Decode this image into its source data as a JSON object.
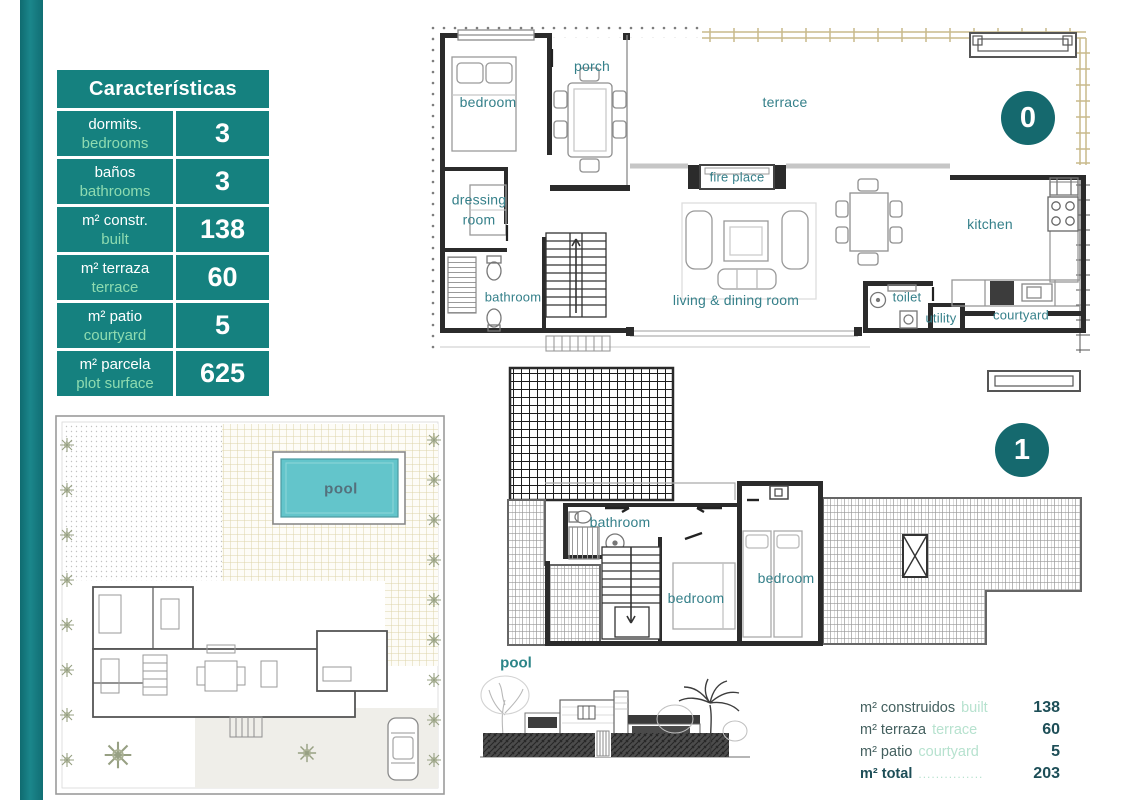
{
  "colors": {
    "accent_teal": "#15817f",
    "badge_teal": "#15696e",
    "mint_green": "#8edbb0",
    "room_label_teal": "#35808a",
    "pool_cyan": "#63c5cb"
  },
  "characteristics_table": {
    "title": "Características",
    "rows": [
      {
        "label_es": "dormits.",
        "label_en": "bedrooms",
        "value": "3"
      },
      {
        "label_es": "baños",
        "label_en": "bathrooms",
        "value": "3"
      },
      {
        "label_es": "m² constr.",
        "label_en": "built",
        "value": "138"
      },
      {
        "label_es": "m² terraza",
        "label_en": "terrace",
        "value": "60"
      },
      {
        "label_es": "m² patio",
        "label_en": "courtyard",
        "value": "5"
      },
      {
        "label_es": "m² parcela",
        "label_en": "plot surface",
        "value": "625"
      }
    ]
  },
  "floor0": {
    "badge": "0",
    "rooms": {
      "bedroom": "bedroom",
      "porch": "porch",
      "terrace": "terrace",
      "dressing_room": "dressing room",
      "bathroom": "bathroom",
      "fire_place": "fire place",
      "living_dining": "living & dining room",
      "kitchen": "kitchen",
      "toilet": "toilet",
      "utility": "utility",
      "courtyard": "courtyard"
    }
  },
  "floor1": {
    "badge": "1",
    "rooms": {
      "bathroom": "bathroom",
      "bedroom_1": "bedroom",
      "bedroom_2": "bedroom"
    }
  },
  "site_plan": {
    "pool_label": "pool"
  },
  "elevation": {
    "pool_label": "pool"
  },
  "summary": {
    "rows": [
      {
        "label_es": "m² construidos",
        "label_en": "built",
        "value": "138"
      },
      {
        "label_es": "m² terraza",
        "label_en": "terrace",
        "value": "60"
      },
      {
        "label_es": "m² patio",
        "label_en": "courtyard",
        "value": "5"
      },
      {
        "label_es": "m² total",
        "label_en": "...............",
        "value": "203"
      }
    ]
  }
}
